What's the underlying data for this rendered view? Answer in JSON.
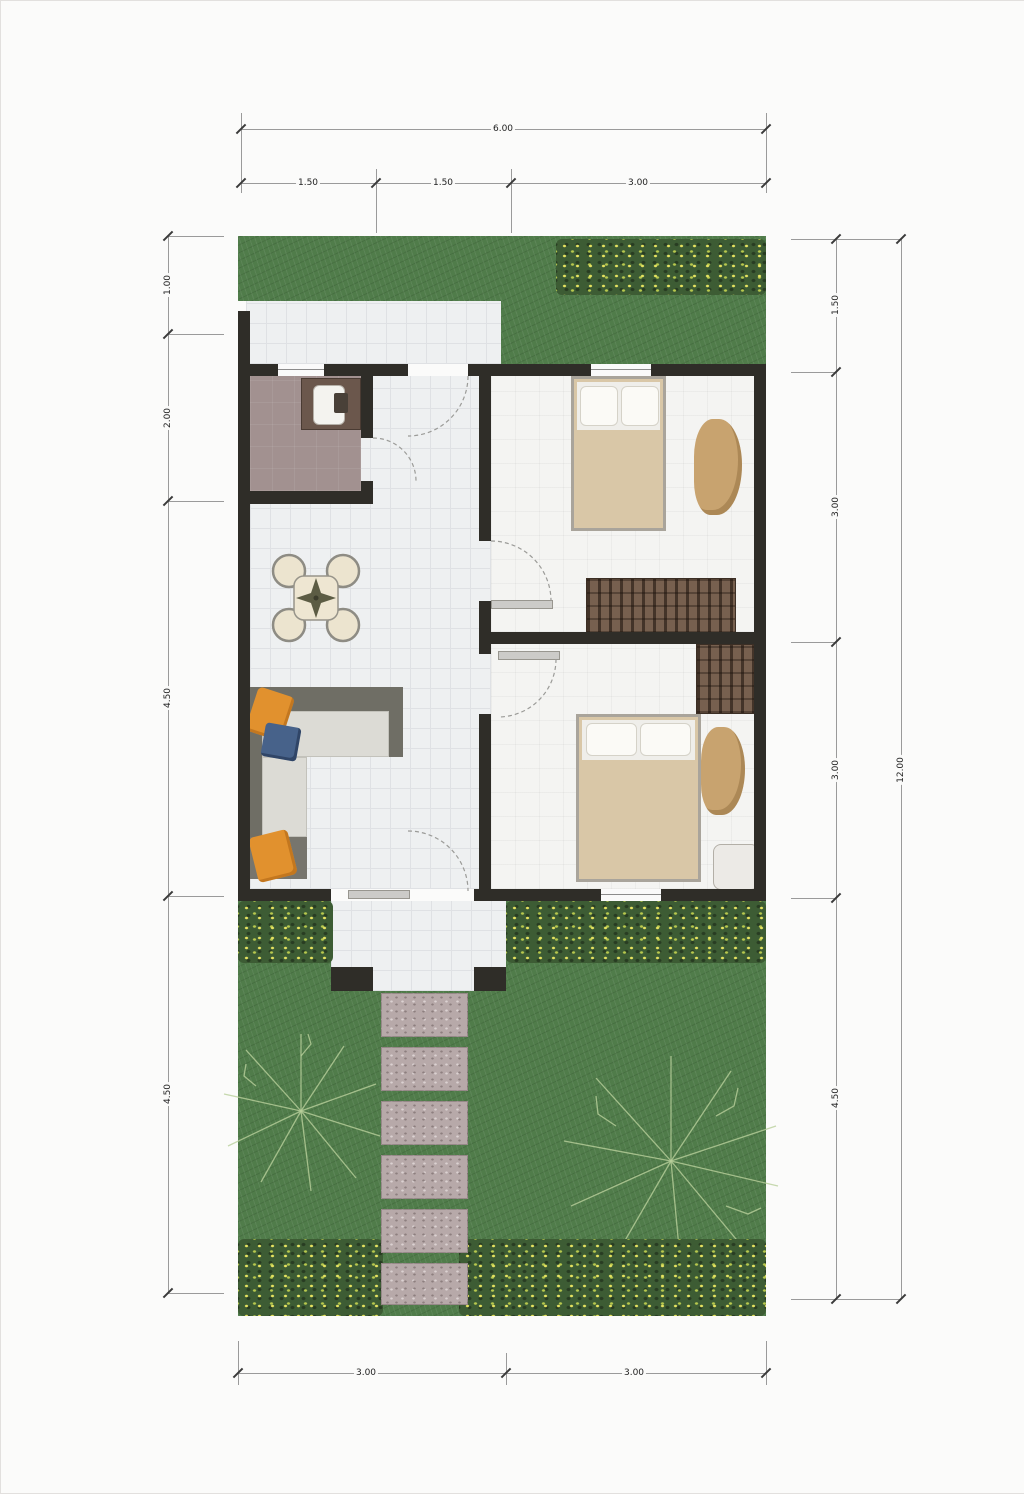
{
  "plan": {
    "type": "residential-floor-plan",
    "rooms_visible_text": "none"
  },
  "dims": {
    "top_total": "6.00",
    "top": [
      "1.50",
      "1.50",
      "3.00"
    ],
    "left": [
      "1.00",
      "2.00",
      "4.50",
      "4.50"
    ],
    "right": [
      "1.50",
      "3.00",
      "3.00",
      "4.50"
    ],
    "right_total": "12.00",
    "bottom": [
      "3.00",
      "3.00"
    ]
  },
  "colors": {
    "wall": "#2f2d28",
    "grass": "#507c4a",
    "bush_green": "#3d5c34",
    "flower_yellow": "#e6e260",
    "floor_tile": "#eef0f1",
    "study_floor": "#a29190",
    "bed_blanket_tan": "#d9c7a7",
    "dresser_brown": "#77604f",
    "sofa_gray": "#6f6e65",
    "cushion_orange": "#e1912e",
    "cushion_navy": "#47628a",
    "stepping_stone": "#b7a9a9",
    "dimension_line": "#9a9a9a"
  }
}
